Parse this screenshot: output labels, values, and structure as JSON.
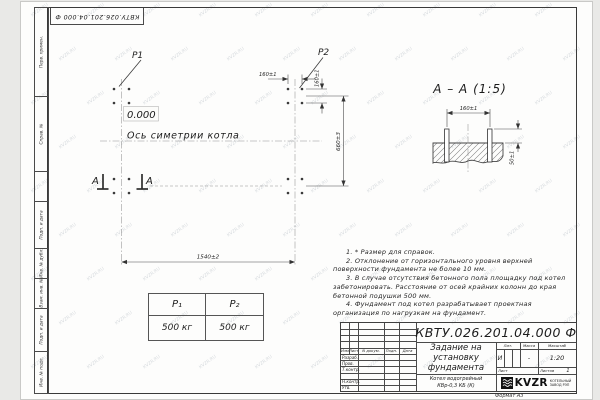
{
  "watermark": "KVZR.RU",
  "stamp": {
    "doc_number_rotated": "КВТУ.026.201.04.000  Ф"
  },
  "margin": {
    "labels": [
      "Перв. примен.",
      "Справ. №",
      "Подп. и дата",
      "Инв. № дубл.",
      "Взам. инв. №",
      "Подп. и дата",
      "Инв. № подл."
    ]
  },
  "plan": {
    "p1": "P1",
    "p2": "P2",
    "elevation": "0.000",
    "axis_label": "Ось симетрии котла",
    "section_letter_1": "А",
    "section_letter_2": "А",
    "dim_bolt_spacing_x": "160±1",
    "dim_bolt_spacing_y": "160±1",
    "dim_length": "1540±2",
    "dim_width": "660±3"
  },
  "section": {
    "title": "А – А (1:5)",
    "dim_spacing": "160±1",
    "dim_height": "50±1"
  },
  "loads_table": {
    "col1_header": "P₁",
    "col2_header": "P₂",
    "col1_value": "500 кг",
    "col2_value": "500 кг"
  },
  "notes": [
    "1. * Размер для справок.",
    "2. Отклонение от горизонтального уровня верхней поверхности фундамента не более 10 мм.",
    "3. В случае отсутствия бетонного пола площадку под котел забетонировать. Расстояние от осей крайних колонн до края бетонной подушки 500 мм.",
    "4. Фундамент под котел разрабатывает проектная организация по нагрузкам на фундамент."
  ],
  "title_block": {
    "doc_number": "КВТУ.026.201.04.000  Ф",
    "title": "Задание на\nустановку\nфундамента",
    "product": "Котел водогрейный\nКВр-0,3 КБ (К)",
    "header_cols": {
      "izm": "Изм.",
      "list": "Лист",
      "doc": "N докум.",
      "podp": "Подп.",
      "data": "Дата"
    },
    "rows": [
      "Разраб.",
      "Пров.",
      "Т.контр.",
      "",
      "Н.контр.",
      "Утв."
    ],
    "lit_label": "Лит.",
    "mass_label": "Масса",
    "scale_label": "Масштаб",
    "lit_value": "И",
    "mass_value": "-",
    "scale_value": "1:20",
    "sheet_label": "Лист",
    "sheets_label": "Листов",
    "sheets_value": "1",
    "logo_text": "KVZR",
    "org_text": "КОТЕЛЬНЫЙ\nЗАВОД РЭП",
    "format_label": "Формат А3"
  }
}
